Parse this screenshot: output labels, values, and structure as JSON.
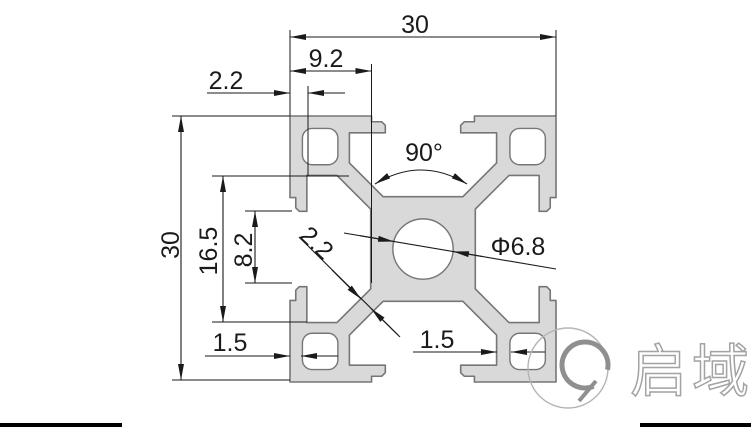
{
  "drawing": {
    "dimensions": {
      "overall_width": "30",
      "overall_height": "30",
      "face_width": "9.2",
      "lip_offset": "2.2",
      "slot_chamber_width": "16.5",
      "slot_opening": "8.2",
      "bottom_left_wall": "1.5",
      "bottom_right_wall": "1.5",
      "slot_angle": "90°",
      "center_bore": "Φ6.8",
      "web_thickness": "2.2"
    },
    "colors": {
      "profile_fill": "#d9d9d9",
      "profile_outline": "#767676",
      "dimension_color": "#1a1a1a",
      "background": "#ffffff",
      "logo_gray": "#a3a3a3"
    },
    "logo": {
      "text": "启域",
      "mark_icon": "q-circle-icon"
    }
  }
}
